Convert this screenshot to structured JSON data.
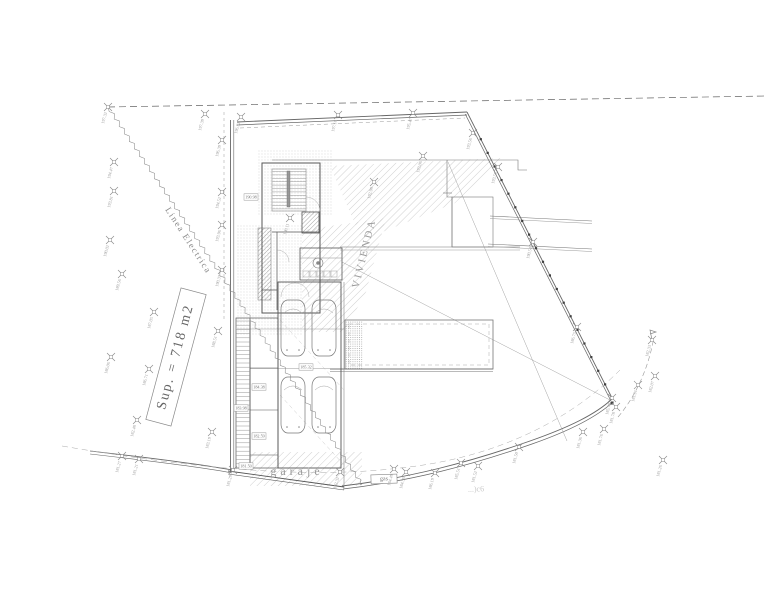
{
  "drawing": {
    "area_label": "Sup. = 718 m2",
    "power_line_label": "Linea Electrica",
    "house_label": "VIVIENDA",
    "garage_label": "garaje",
    "gas_label": "gas",
    "road_text": "...)c6"
  },
  "colors": {
    "wall": "#555555",
    "thin": "#8a8a8a",
    "light": "#b5b5b5",
    "text_gray": "#999999"
  },
  "survey_markers": [
    {
      "x": 108,
      "y": 107,
      "v": "197.32"
    },
    {
      "x": 205,
      "y": 114,
      "v": "197.39"
    },
    {
      "x": 241,
      "y": 117,
      "v": "196.52"
    },
    {
      "x": 338,
      "y": 115,
      "v": "197.16"
    },
    {
      "x": 413,
      "y": 113,
      "v": "195.47"
    },
    {
      "x": 473,
      "y": 133,
      "v": "193.56"
    },
    {
      "x": 498,
      "y": 167,
      "v": "193.50"
    },
    {
      "x": 533,
      "y": 242,
      "v": "190.54"
    },
    {
      "x": 577,
      "y": 327,
      "v": "186.75"
    },
    {
      "x": 612,
      "y": 398,
      "v": "185.79"
    },
    {
      "x": 616,
      "y": 407,
      "v": "181.78"
    },
    {
      "x": 652,
      "y": 340,
      "v": "182.33"
    },
    {
      "x": 655,
      "y": 376,
      "v": "182.07"
    },
    {
      "x": 638,
      "y": 385,
      "v": "181.91"
    },
    {
      "x": 604,
      "y": 429,
      "v": "181.76"
    },
    {
      "x": 663,
      "y": 460,
      "v": "181.26"
    },
    {
      "x": 583,
      "y": 432,
      "v": "181.36"
    },
    {
      "x": 519,
      "y": 447,
      "v": "181.50"
    },
    {
      "x": 478,
      "y": 466,
      "v": "181.52"
    },
    {
      "x": 461,
      "y": 463,
      "v": "185.51"
    },
    {
      "x": 435,
      "y": 473,
      "v": "186.19"
    },
    {
      "x": 406,
      "y": 472,
      "v": "184.56"
    },
    {
      "x": 394,
      "y": 469,
      "v": "184.49"
    },
    {
      "x": 340,
      "y": 472,
      "v": "182.32"
    },
    {
      "x": 233,
      "y": 470,
      "v": "181.29"
    },
    {
      "x": 139,
      "y": 459,
      "v": "181.21"
    },
    {
      "x": 122,
      "y": 456,
      "v": "181.27"
    },
    {
      "x": 114,
      "y": 162,
      "v": "194.47"
    },
    {
      "x": 114,
      "y": 191,
      "v": "193.81"
    },
    {
      "x": 110,
      "y": 240,
      "v": "190.02"
    },
    {
      "x": 122,
      "y": 274,
      "v": "189.56"
    },
    {
      "x": 111,
      "y": 357,
      "v": "186.06"
    },
    {
      "x": 149,
      "y": 369,
      "v": "186.71"
    },
    {
      "x": 154,
      "y": 312,
      "v": "187.05"
    },
    {
      "x": 218,
      "y": 331,
      "v": "188.51"
    },
    {
      "x": 137,
      "y": 420,
      "v": "182.48"
    },
    {
      "x": 212,
      "y": 432,
      "v": "183.19"
    },
    {
      "x": 222,
      "y": 140,
      "v": "196.39"
    },
    {
      "x": 222,
      "y": 192,
      "v": "194.52"
    },
    {
      "x": 222,
      "y": 225,
      "v": "193.96"
    },
    {
      "x": 222,
      "y": 270,
      "v": "190.37"
    },
    {
      "x": 374,
      "y": 182,
      "v": "192.98"
    },
    {
      "x": 423,
      "y": 156,
      "v": "193.06"
    },
    {
      "x": 290,
      "y": 218,
      "v": "190.11"
    }
  ],
  "boxed_levels": [
    {
      "x": 251,
      "y": 197,
      "v": "190.98"
    },
    {
      "x": 306,
      "y": 367,
      "v": "185.32"
    },
    {
      "x": 259,
      "y": 387,
      "v": "184.38"
    },
    {
      "x": 241,
      "y": 408,
      "v": "183.98"
    },
    {
      "x": 259,
      "y": 436,
      "v": "182.59"
    },
    {
      "x": 246,
      "y": 466,
      "v": "181.50"
    }
  ]
}
